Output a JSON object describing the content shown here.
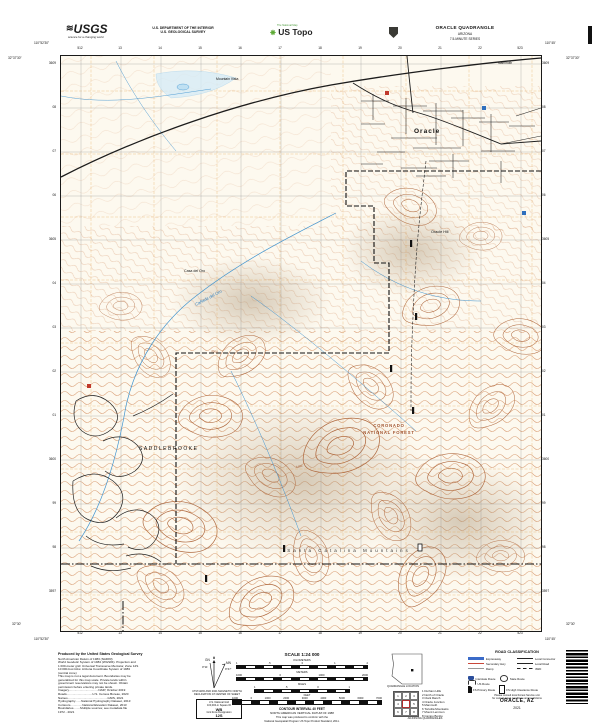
{
  "header": {
    "usgs_logo": "USGS",
    "usgs_tagline": "science for a changing world",
    "dept1": "U.S. DEPARTMENT OF THE INTERIOR",
    "dept2": "U.S. GEOLOGICAL SURVEY",
    "natmap": "The National Map",
    "ustopo": "US Topo",
    "quad_title": "ORACLE QUADRANGLE",
    "quad_state": "ARIZONA",
    "quad_series": "7.5-MINUTE SERIES"
  },
  "map": {
    "labels": {
      "town": "Oracle",
      "saddlebrooke": "SADDLEBROOKE",
      "forest_line1": "CORONADO",
      "forest_line2": "NATIONAL FOREST",
      "range": "Santa Catalina Mountains",
      "wash": "Cañada del Oro",
      "locale": "Casa del Oro",
      "hill": "Oracle Hill",
      "vista": "Mountain Vista",
      "mammoth": "Mammoth",
      "elev1": "4400",
      "elev2": "3900"
    },
    "grid": {
      "top": [
        "512",
        "13",
        "14",
        "15",
        "16",
        "17",
        "18",
        "19",
        "20",
        "21",
        "22",
        "523"
      ],
      "bottom": [
        "512",
        "13",
        "14",
        "15",
        "16",
        "17",
        "18",
        "19",
        "20",
        "21",
        "22",
        "523"
      ],
      "left": [
        "3609",
        "08",
        "07",
        "06",
        "3605",
        "04",
        "03",
        "02",
        "01",
        "3600",
        "99",
        "98",
        "3597"
      ],
      "right": [
        "3609",
        "08",
        "07",
        "06",
        "3605",
        "04",
        "03",
        "02",
        "01",
        "3600",
        "99",
        "98",
        "3597"
      ],
      "corner_tl_lon": "110°52'30\"",
      "corner_tl_lat": "32°37'30\"",
      "corner_tr_lon": "110°45'",
      "corner_tr_lat": "32°37'30\"",
      "corner_bl_lat": "32°30'",
      "corner_bl_lon": "110°52'30\"",
      "corner_br_lat": "32°30'",
      "corner_br_lon": "110°45'"
    }
  },
  "footer": {
    "produced_title": "Produced by the United States Geological Survey",
    "produced_lines": [
      "North American Datum of 1983 (NAD83)",
      "World Geodetic System of 1984 (WGS84). Projection and",
      "1 000-meter grid: Universal Transverse Mercator, Zone 12S",
      "10 000-foot ticks: Arizona Coordinate System of 1983",
      "(central zone)",
      "This map is not a legal document. Boundaries may be",
      "generalized for this map scale. Private lands within",
      "government reservations may not be shown. Obtain",
      "permission before entering private lands.",
      "Imagery...................................NAIP, October 2019",
      "Roads..............................U.S. Census Bureau, 2020",
      "Names...............................................GNIS, 2021",
      "Hydrography.......National Hydrography Dataset, 2013",
      "Contours..............National Elevation Dataset, 2013",
      "Boundaries........Multiple sources; see metadata file",
      "1972 - 2021"
    ],
    "declination": {
      "caption1": "UTM GRID AND 2021 MAGNETIC NORTH",
      "caption2": "DECLINATION AT CENTER OF SHEET",
      "gn": "GN",
      "mn": "MN",
      "gn_val": "0°11'",
      "mn_val": "9°47'"
    },
    "usng": {
      "title": "U.S. National Grid",
      "l1": "100,000-m Square ID",
      "id": "WB",
      "l2": "Grid Zone Designation",
      "zone": "12S"
    },
    "scale": {
      "title": "SCALE 1:24 000",
      "bars": {
        "km": {
          "unit": "KILOMETERS",
          "ticks": [
            "1",
            ".5",
            "0",
            "1",
            "2"
          ]
        },
        "m": {
          "unit": "METERS",
          "ticks": [
            "1000",
            "0",
            "1000",
            "2000"
          ]
        },
        "mi": {
          "unit": "MILES",
          "ticks": [
            "1",
            ".5",
            "0",
            "1"
          ]
        },
        "ft": {
          "unit": "FEET",
          "ticks": [
            "1000",
            "0",
            "1000",
            "2000",
            "3000",
            "4000",
            "5000",
            "6000",
            "7000"
          ]
        }
      },
      "contour1": "CONTOUR INTERVAL 40 FEET",
      "contour2": "NORTH AMERICAN VERTICAL DATUM OF 1988",
      "std1": "This map was produced to conform with the",
      "std2": "National Geospatial Program US Topo Product Standard, 2011."
    },
    "location_caption": "QUADRANGLE LOCATION",
    "adjoining": {
      "caption": "ADJOINING QUADRANGLES",
      "cells": [
        "1",
        "2",
        "3",
        "4",
        "",
        "5",
        "6",
        "7",
        "8"
      ],
      "names": [
        "1 Durham Hills",
        "2 North of Oracle",
        "3 Clark Ranch",
        "4 Oracle Junction",
        "5 Mammoth",
        "6 Tortolita Mountains",
        "7 Mount Lemmon",
        "8 Campo Bonito"
      ]
    },
    "road_class": {
      "title": "ROAD CLASSIFICATION",
      "expressway": "Expressway",
      "secondary": "Secondary Hwy",
      "ramp": "Ramp",
      "local_connector": "Local Connector",
      "local_road": "Local Road",
      "fwd": "4WD",
      "interstate": "Interstate Route",
      "us_route": "US Route",
      "state_route": "State Route",
      "fs_primary": "FS Primary Route",
      "fs_high": "FS High Clearance Route",
      "note1": "Please consult local Forest Service unit",
      "note2": "for current travel conditions and restrictions"
    },
    "imprint_title": "ORACLE, AZ",
    "imprint_year": "2021"
  }
}
